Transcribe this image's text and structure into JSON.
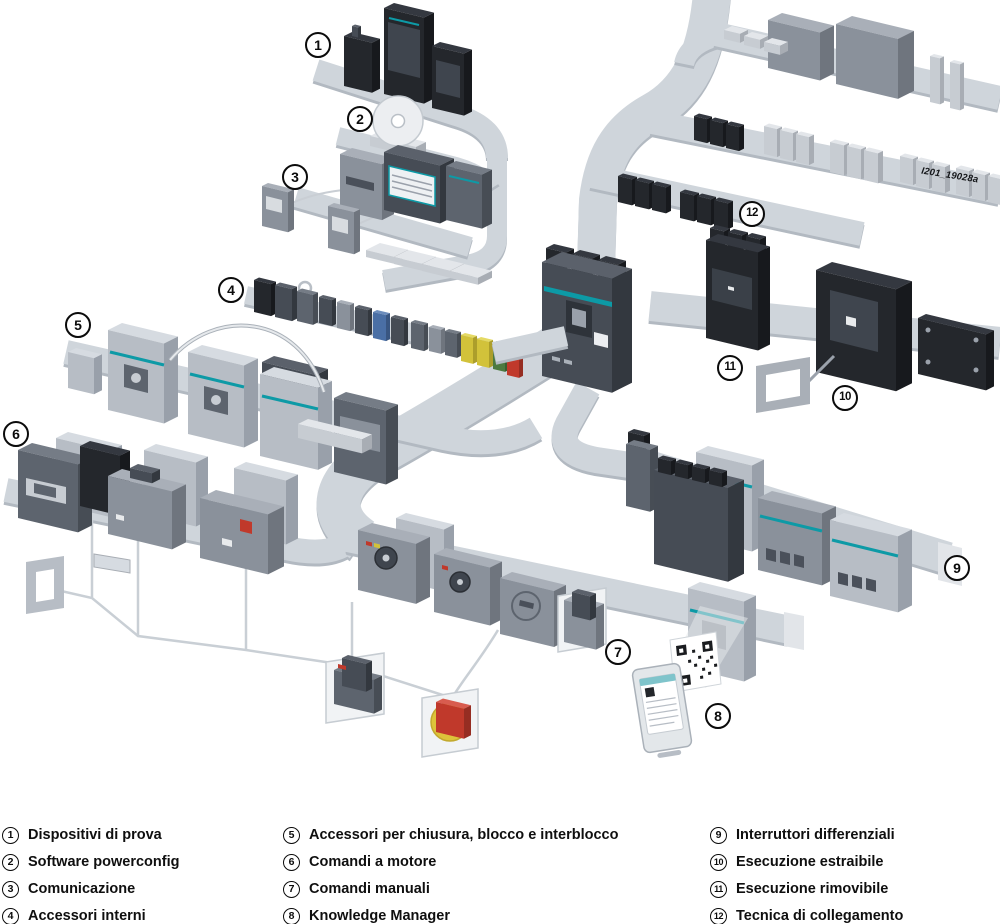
{
  "diagram": {
    "watermark": "I201_19028a",
    "callouts": [
      {
        "n": "1"
      },
      {
        "n": "2"
      },
      {
        "n": "3"
      },
      {
        "n": "4"
      },
      {
        "n": "5"
      },
      {
        "n": "6"
      },
      {
        "n": "7"
      },
      {
        "n": "8"
      },
      {
        "n": "9"
      },
      {
        "n": "10"
      },
      {
        "n": "11"
      },
      {
        "n": "12"
      }
    ]
  },
  "legend": {
    "columns": [
      {
        "items": [
          {
            "n": "1",
            "label": "Dispositivi di prova"
          },
          {
            "n": "2",
            "label": "Software powerconfig"
          },
          {
            "n": "3",
            "label": "Comunicazione"
          },
          {
            "n": "4",
            "label": "Accessori interni"
          }
        ]
      },
      {
        "items": [
          {
            "n": "5",
            "label": "Accessori per chiusura, blocco e interblocco"
          },
          {
            "n": "6",
            "label": "Comandi a motore"
          },
          {
            "n": "7",
            "label": "Comandi manuali"
          },
          {
            "n": "8",
            "label": "Knowledge Manager"
          }
        ]
      },
      {
        "items": [
          {
            "n": "9",
            "label": "Interruttori differenziali"
          },
          {
            "n": "10",
            "label": "Esecuzione estraibile"
          },
          {
            "n": "11",
            "label": "Esecuzione rimovibile"
          },
          {
            "n": "12",
            "label": "Tecnica di collegamento"
          }
        ]
      }
    ]
  },
  "colors": {
    "rail": "#cfd5db",
    "rail_edge": "#b2b9c1",
    "accent_teal": "#0d9aa6",
    "device_dark": "#464c55",
    "device_light": "#b7bdc5",
    "background": "#ffffff"
  }
}
